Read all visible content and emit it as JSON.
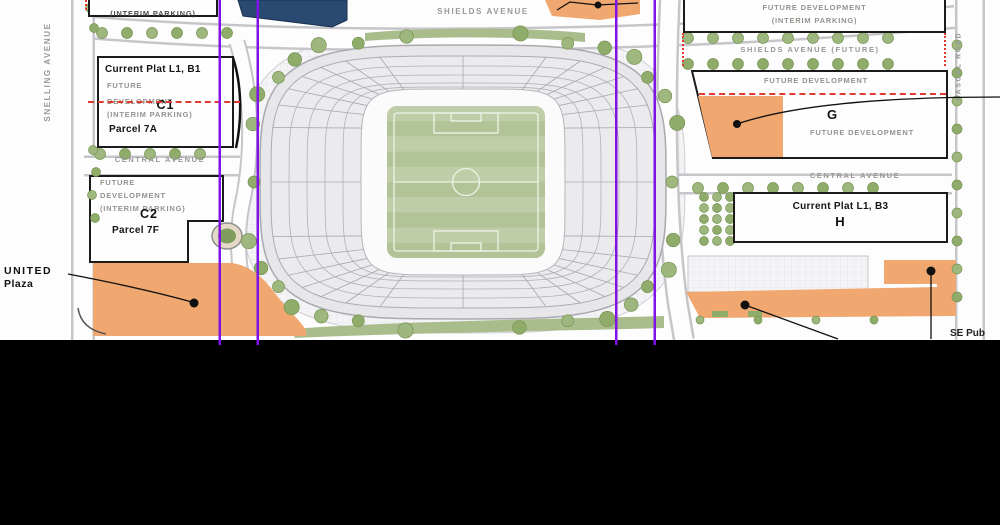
{
  "streets": {
    "snelling": "SNELLING AVENUE",
    "shields": "SHIELDS AVENUE",
    "shields_future": "SHIELDS AVENUE (FUTURE)",
    "central_left": "CENTRAL AVENUE",
    "central_right": "CENTRAL AVENUE",
    "pascal": "PASCAL ROAD"
  },
  "parcels": {
    "top_left": {
      "line1": "(INTERIM PARKING)"
    },
    "c1": {
      "title": "Current Plat L1, B1",
      "line1": "FUTURE",
      "line2": "DEVELOPMENT",
      "code": "C1",
      "line3": "(INTERIM PARKING)",
      "parcel": "Parcel 7A"
    },
    "c2": {
      "line1": "FUTURE",
      "line2": "DEVELOPMENT",
      "line3": "(INTERIM PARKING)",
      "code": "C2",
      "parcel": "Parcel 7F"
    },
    "top_right": {
      "line1": "FUTURE DEVELOPMENT",
      "line2": "(INTERIM PARKING)"
    },
    "g": {
      "top": "FUTURE DEVELOPMENT",
      "code": "G",
      "sub": "FUTURE DEVELOPMENT"
    },
    "h": {
      "title": "Current Plat L1, B3",
      "code": "H"
    }
  },
  "annotations": {
    "united_line1": "UNITED",
    "united_line2": "Plaza",
    "se_label": "SE Pub"
  },
  "colors": {
    "plaza_orange": "#F1A870",
    "gridline_purple": "#8012E6",
    "boundary_red": "#E03A30",
    "building_blue": "#2A4A72",
    "pitch_green": "#B9C9A0",
    "tree_green": "#8FAC6B"
  }
}
